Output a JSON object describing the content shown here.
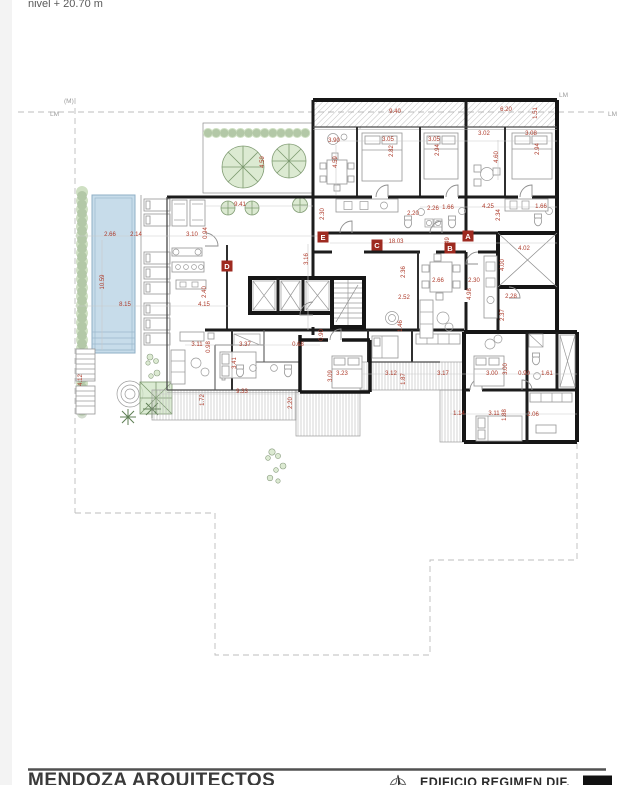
{
  "annotations": {
    "level_note": "nivel + 20.70 m"
  },
  "boundary": {
    "labels": [
      {
        "t": "(M)",
        "x": 64,
        "y": 103
      },
      {
        "t": "LM",
        "x": 50,
        "y": 116
      },
      {
        "t": "LM",
        "x": 559,
        "y": 97
      },
      {
        "t": "LM",
        "x": 608,
        "y": 116
      }
    ]
  },
  "grid_bubbles": [
    {
      "t": "E",
      "x": 323,
      "y": 237
    },
    {
      "t": "C",
      "x": 377,
      "y": 245
    },
    {
      "t": "A",
      "x": 468,
      "y": 236
    },
    {
      "t": "B",
      "x": 450,
      "y": 248
    },
    {
      "t": "D",
      "x": 227,
      "y": 266
    }
  ],
  "dimensions": [
    {
      "t": "9.40",
      "x": 395,
      "y": 113
    },
    {
      "t": "6.20",
      "x": 506,
      "y": 111
    },
    {
      "t": "1.51",
      "x": 537,
      "y": 113,
      "r": 1
    },
    {
      "t": "3.90",
      "x": 334,
      "y": 142
    },
    {
      "t": "3.05",
      "x": 388,
      "y": 141
    },
    {
      "t": "2.82",
      "x": 393,
      "y": 151,
      "r": 1
    },
    {
      "t": "3.05",
      "x": 434,
      "y": 141
    },
    {
      "t": "2.94",
      "x": 439,
      "y": 150,
      "r": 1
    },
    {
      "t": "3.02",
      "x": 484,
      "y": 135
    },
    {
      "t": "3.08",
      "x": 531,
      "y": 135
    },
    {
      "t": "2.94",
      "x": 539,
      "y": 149,
      "r": 1
    },
    {
      "t": "4.59",
      "x": 337,
      "y": 162,
      "r": 1
    },
    {
      "t": "4.60",
      "x": 498,
      "y": 157,
      "r": 1
    },
    {
      "t": "9.41",
      "x": 240,
      "y": 206
    },
    {
      "t": "4.59",
      "x": 264,
      "y": 162,
      "r": 1
    },
    {
      "t": "4.25",
      "x": 488,
      "y": 208
    },
    {
      "t": "2.34",
      "x": 500,
      "y": 215,
      "r": 1
    },
    {
      "t": "1.66",
      "x": 541,
      "y": 208
    },
    {
      "t": "2.26",
      "x": 433,
      "y": 210
    },
    {
      "t": "2.20",
      "x": 413,
      "y": 215
    },
    {
      "t": "1.66",
      "x": 448,
      "y": 209
    },
    {
      "t": "2.30",
      "x": 324,
      "y": 214,
      "r": 1
    },
    {
      "t": "18.03",
      "x": 396,
      "y": 243
    },
    {
      "t": "1.49",
      "x": 449,
      "y": 243,
      "r": 1
    },
    {
      "t": "3.16",
      "x": 308,
      "y": 259,
      "r": 1
    },
    {
      "t": "2.66",
      "x": 110,
      "y": 236
    },
    {
      "t": "2.14",
      "x": 136,
      "y": 236
    },
    {
      "t": "3.10",
      "x": 192,
      "y": 236
    },
    {
      "t": "0.94",
      "x": 207,
      "y": 233,
      "r": 1
    },
    {
      "t": "10.59",
      "x": 104,
      "y": 282,
      "r": 1
    },
    {
      "t": "8.15",
      "x": 125,
      "y": 306
    },
    {
      "t": "2.40",
      "x": 206,
      "y": 292,
      "r": 1
    },
    {
      "t": "4.15",
      "x": 204,
      "y": 306
    },
    {
      "t": "3.11",
      "x": 197,
      "y": 346
    },
    {
      "t": "0.98",
      "x": 210,
      "y": 347,
      "r": 1
    },
    {
      "t": "4.12",
      "x": 82,
      "y": 380,
      "r": 1
    },
    {
      "t": "4.02",
      "x": 524,
      "y": 250
    },
    {
      "t": "4.00",
      "x": 504,
      "y": 265,
      "r": 1
    },
    {
      "t": "2.28",
      "x": 511,
      "y": 298
    },
    {
      "t": "2.37",
      "x": 504,
      "y": 315,
      "r": 1
    },
    {
      "t": "2.66",
      "x": 438,
      "y": 282
    },
    {
      "t": "2.30",
      "x": 474,
      "y": 282
    },
    {
      "t": "4.98",
      "x": 471,
      "y": 294,
      "r": 1
    },
    {
      "t": "2.36",
      "x": 405,
      "y": 272,
      "r": 1
    },
    {
      "t": "2.52",
      "x": 404,
      "y": 299
    },
    {
      "t": "1.46",
      "x": 402,
      "y": 326,
      "r": 1
    },
    {
      "t": "0.90",
      "x": 323,
      "y": 335,
      "r": 1
    },
    {
      "t": "3.37",
      "x": 245,
      "y": 346
    },
    {
      "t": "3.41",
      "x": 236,
      "y": 363,
      "r": 1
    },
    {
      "t": "0.68",
      "x": 298,
      "y": 346
    },
    {
      "t": "3.09",
      "x": 332,
      "y": 376,
      "r": 1
    },
    {
      "t": "3.23",
      "x": 342,
      "y": 375
    },
    {
      "t": "3.12",
      "x": 391,
      "y": 375
    },
    {
      "t": "1.87",
      "x": 405,
      "y": 379,
      "r": 1
    },
    {
      "t": "3.17",
      "x": 443,
      "y": 375
    },
    {
      "t": "3.00",
      "x": 492,
      "y": 375
    },
    {
      "t": "3.00",
      "x": 507,
      "y": 369,
      "r": 1
    },
    {
      "t": "0.90",
      "x": 524,
      "y": 375
    },
    {
      "t": "1.61",
      "x": 547,
      "y": 375
    },
    {
      "t": "9.33",
      "x": 242,
      "y": 393
    },
    {
      "t": "1.72",
      "x": 204,
      "y": 400,
      "r": 1
    },
    {
      "t": "2.20",
      "x": 292,
      "y": 403,
      "r": 1
    },
    {
      "t": "1.14",
      "x": 459,
      "y": 415
    },
    {
      "t": "3.11",
      "x": 494,
      "y": 415
    },
    {
      "t": "1.88",
      "x": 506,
      "y": 415,
      "r": 1
    },
    {
      "t": "2.06",
      "x": 533,
      "y": 416
    }
  ],
  "footer": {
    "firm_title": "MENDOZA ARQUITECTOS",
    "project_title": "EDIFICIO REGIMEN DIF.",
    "compass_icon": "north-compass-icon",
    "logo_block": "black-logo-block"
  },
  "colors": {
    "dim_text": "#ad3a2a",
    "grid_bubble": "#9e2a20",
    "wall": "#161616",
    "pool_fill": "#c7dcea",
    "green_fill": "#dcead2",
    "boundary_dash": "#bdbdbd"
  }
}
